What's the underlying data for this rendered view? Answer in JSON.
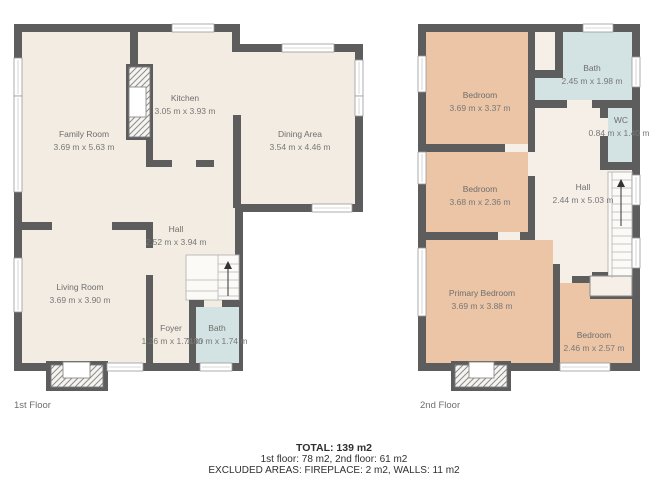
{
  "first_floor": {
    "label": "1st Floor",
    "rooms": [
      {
        "name": "Family Room",
        "dims": "3.69 m x 5.63 m"
      },
      {
        "name": "Kitchen",
        "dims": "3.05 m x 3.93 m"
      },
      {
        "name": "Dining Area",
        "dims": "3.54 m x 4.46 m"
      },
      {
        "name": "Hall",
        "dims": "2.52 m x 3.94 m"
      },
      {
        "name": "Living Room",
        "dims": "3.69 m x 3.90 m"
      },
      {
        "name": "Foyer",
        "dims": "1.26 m x 1.74 m"
      },
      {
        "name": "Bath",
        "dims": "1.80 m x 1.74 m"
      }
    ]
  },
  "second_floor": {
    "label": "2nd Floor",
    "rooms": [
      {
        "name": "Bedroom",
        "dims": "3.69 m x 3.37 m"
      },
      {
        "name": "Bath",
        "dims": "2.45 m x 1.98 m"
      },
      {
        "name": "WC",
        "dims": "0.84 m x 1.40 m"
      },
      {
        "name": "Bedroom",
        "dims": "3.68 m x 2.36 m"
      },
      {
        "name": "Hall",
        "dims": "2.44 m x 5.03 m"
      },
      {
        "name": "Primary Bedroom",
        "dims": "3.69 m x 3.88 m"
      },
      {
        "name": "Bedroom",
        "dims": "2.46 m x 2.57 m"
      }
    ]
  },
  "footer": {
    "total": "TOTAL: 139 m2",
    "floors": "1st floor: 78 m2, 2nd floor: 61 m2",
    "excluded": "EXCLUDED AREAS: FIREPLACE: 2 m2, WALLS: 11 m2"
  },
  "colors": {
    "wall": "#5d5d5d",
    "floor_cream": "#f3ece3",
    "hall_cream": "#f5efe7",
    "bedroom_tan": "#ebc5a6",
    "bath_blue": "#d3e2e2",
    "label_text": "#6e6e6e",
    "footer_text": "#2f2f2f"
  }
}
